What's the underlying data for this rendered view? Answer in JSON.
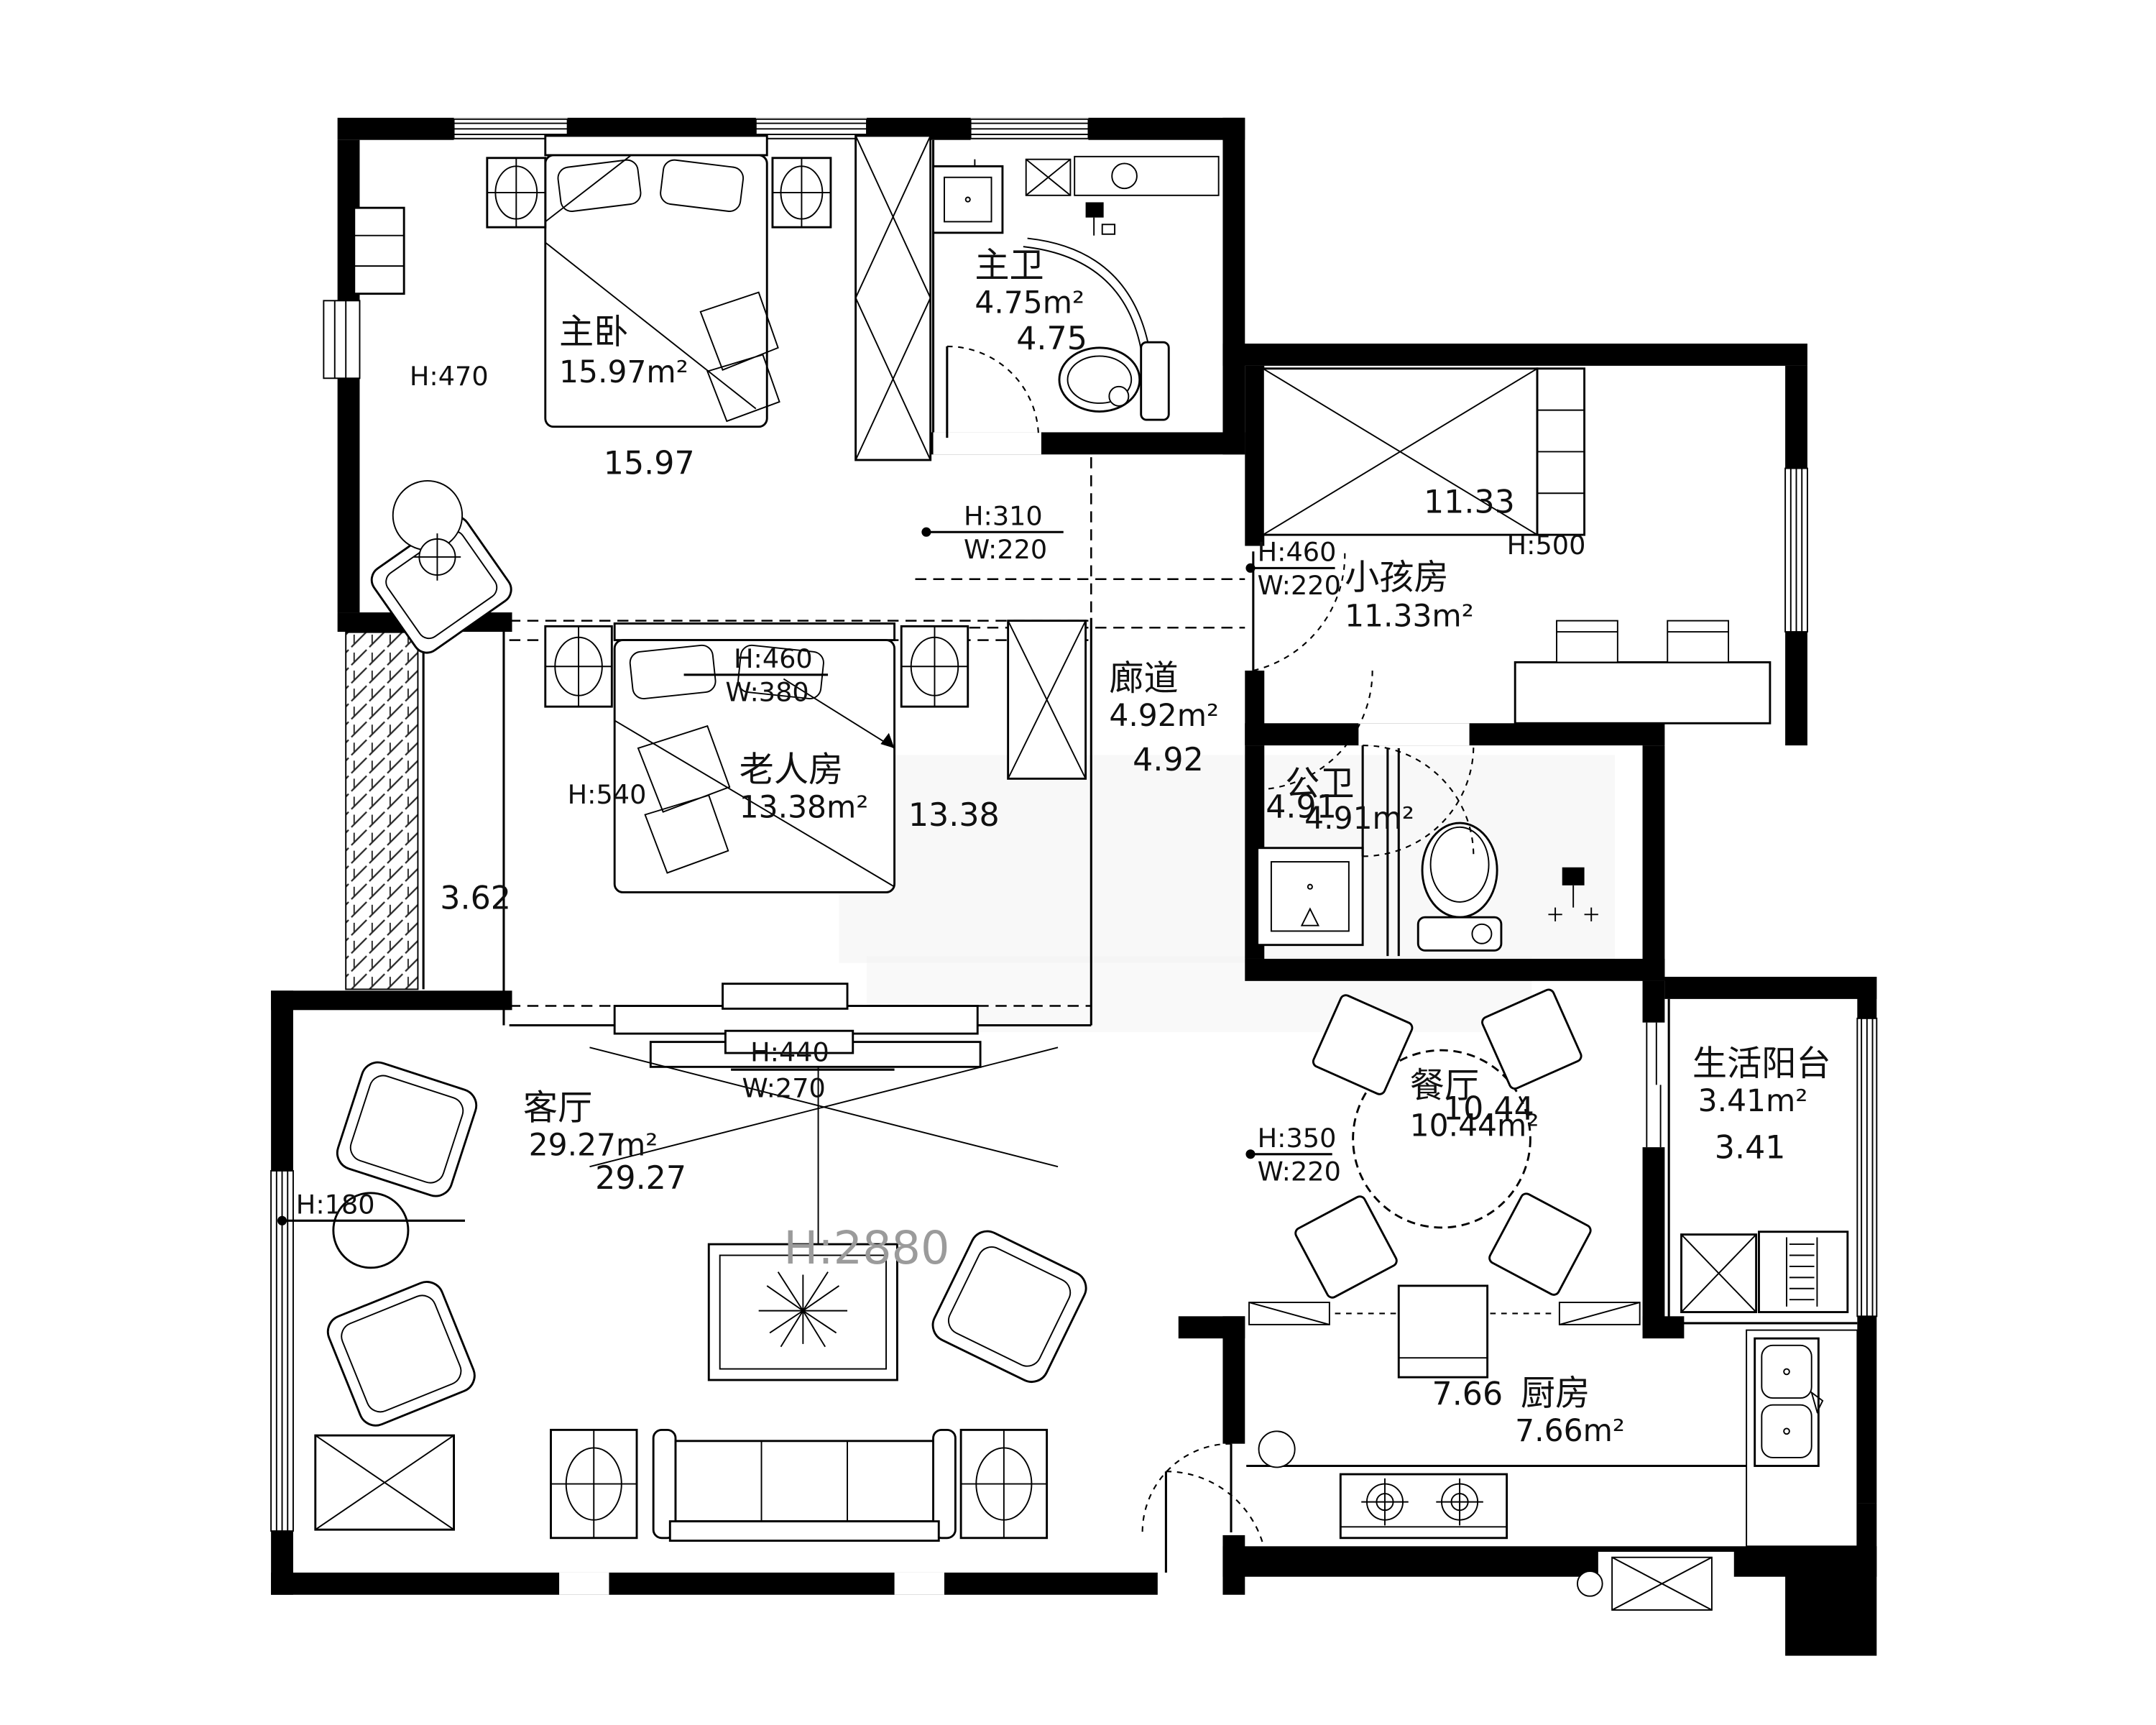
{
  "rooms": {
    "master_bedroom": {
      "name": "主卧",
      "area": "15.97m²",
      "number": "15.97",
      "height": "H:470"
    },
    "master_bath": {
      "name": "主卫",
      "area": "4.75m²",
      "number": "4.75"
    },
    "kids_room": {
      "name": "小孩房",
      "area": "11.33m²",
      "number": "11.33",
      "height": "H:500"
    },
    "corridor": {
      "name": "廊道",
      "area": "4.92m²",
      "number": "4.92"
    },
    "elder_room": {
      "name": "老人房",
      "area": "13.38m²",
      "number": "13.38",
      "height": "H:540"
    },
    "public_bath": {
      "name": "公卫",
      "area": "4.91m²",
      "number": "4.91"
    },
    "living_room": {
      "name": "客厅",
      "area": "29.27m²",
      "number": "29.27",
      "ceiling_height": "H:2880",
      "window_height": "H:180"
    },
    "dining_room": {
      "name": "餐厅",
      "area": "10.44m²",
      "number": "10.44"
    },
    "balcony": {
      "name": "生活阳台",
      "area": "3.41m²",
      "number": "3.41"
    },
    "kitchen": {
      "name": "厨房",
      "area": "7.66m²",
      "number": "7.66"
    },
    "left_shaft": {
      "number": "3.62"
    }
  },
  "window_tags": {
    "w310": {
      "h": "H:310",
      "w": "W:220"
    },
    "w460a": {
      "h": "H:460",
      "w": "W:220"
    },
    "w460b": {
      "h": "H:460",
      "w": "W:380"
    },
    "w440": {
      "h": "H:440",
      "w": "W:270"
    },
    "w350": {
      "h": "H:350",
      "w": "W:220"
    }
  },
  "colors": {
    "wall": "#000000",
    "line": "#101010",
    "faded": "#9b9b9b"
  }
}
